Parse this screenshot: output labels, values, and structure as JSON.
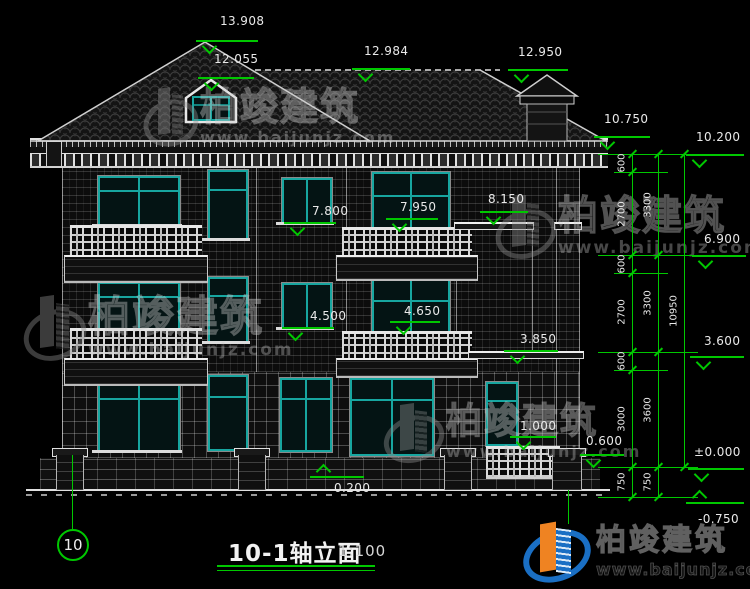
{
  "title_block": {
    "axis_no": "10",
    "title": "10-1轴立面",
    "scale": "1:100"
  },
  "brand": {
    "name": "柏竣建筑",
    "url": "www.baijunjz.com"
  },
  "colors": {
    "annotation_green": "#00c800",
    "window_teal": "#17a6a0",
    "line_white": "#d8d8d8",
    "logo_blue": "#1a6fc4",
    "logo_orange": "#ef8322"
  },
  "level_markers": [
    {
      "label": "13.908",
      "style": "down",
      "tx": 220,
      "ty": 14,
      "lx": 196,
      "ly": 40,
      "lw": 62
    },
    {
      "label": "12.055",
      "style": "down",
      "tx": 214,
      "ty": 52,
      "lx": 198,
      "ly": 77,
      "lw": 56
    },
    {
      "label": "12.984",
      "style": "down",
      "tx": 364,
      "ty": 44,
      "lx": 352,
      "ly": 68,
      "lw": 58
    },
    {
      "label": "12.950",
      "style": "down",
      "tx": 518,
      "ty": 45,
      "lx": 508,
      "ly": 69,
      "lw": 60
    },
    {
      "label": "10.750",
      "style": "down",
      "tx": 604,
      "ty": 112,
      "lx": 594,
      "ly": 136,
      "lw": 56
    },
    {
      "label": "10.200",
      "style": "down",
      "tx": 696,
      "ty": 130,
      "lx": 686,
      "ly": 154,
      "lw": 58
    },
    {
      "label": "6.900",
      "style": "down",
      "tx": 704,
      "ty": 232,
      "lx": 692,
      "ly": 255,
      "lw": 54
    },
    {
      "label": "3.600",
      "style": "down",
      "tx": 704,
      "ty": 334,
      "lx": 690,
      "ly": 356,
      "lw": 54
    },
    {
      "label": "±0.000",
      "style": "down",
      "tx": 694,
      "ty": 445,
      "lx": 688,
      "ly": 468,
      "lw": 56
    },
    {
      "label": "7.800",
      "style": "down",
      "tx": 312,
      "ty": 204,
      "lx": 284,
      "ly": 222,
      "lw": 52
    },
    {
      "label": "7.950",
      "style": "down",
      "tx": 400,
      "ty": 200,
      "lx": 386,
      "ly": 218,
      "lw": 52
    },
    {
      "label": "8.150",
      "style": "down",
      "tx": 488,
      "ty": 192,
      "lx": 480,
      "ly": 211,
      "lw": 48
    },
    {
      "label": "4.500",
      "style": "down",
      "tx": 310,
      "ty": 309,
      "lx": 282,
      "ly": 327,
      "lw": 52
    },
    {
      "label": "4.650",
      "style": "down",
      "tx": 404,
      "ty": 304,
      "lx": 390,
      "ly": 321,
      "lw": 50
    },
    {
      "label": "3.850",
      "style": "down",
      "tx": 520,
      "ty": 332,
      "lx": 504,
      "ly": 350,
      "lw": 54
    },
    {
      "label": "1.000",
      "style": "down",
      "tx": 520,
      "ty": 419,
      "lx": 510,
      "ly": 436,
      "lw": 46
    },
    {
      "label": "0.600",
      "style": "down",
      "tx": 586,
      "ty": 434,
      "lx": 580,
      "ly": 454,
      "lw": 44
    },
    {
      "label": "0.200",
      "style": "up",
      "tx": 334,
      "ty": 481,
      "lx": 310,
      "ly": 476,
      "lw": 54
    },
    {
      "label": "-0.750",
      "style": "up",
      "tx": 698,
      "ty": 512,
      "lx": 686,
      "ly": 502,
      "lw": 58
    }
  ],
  "dim_chains": {
    "extension_lines": [
      {
        "x": 598,
        "y": 154,
        "w": 100
      },
      {
        "x": 614,
        "y": 172,
        "w": 54
      },
      {
        "x": 598,
        "y": 255,
        "w": 100
      },
      {
        "x": 614,
        "y": 273,
        "w": 54
      },
      {
        "x": 598,
        "y": 352,
        "w": 100
      },
      {
        "x": 614,
        "y": 370,
        "w": 54
      },
      {
        "x": 598,
        "y": 467,
        "w": 100
      },
      {
        "x": 598,
        "y": 497,
        "w": 100
      }
    ],
    "chain_lines": [
      {
        "x": 632,
        "y1": 154,
        "y2": 497
      },
      {
        "x": 658,
        "y1": 154,
        "y2": 497
      },
      {
        "x": 684,
        "y1": 154,
        "y2": 467
      }
    ],
    "ticks": [
      {
        "x": 632,
        "y": 154
      },
      {
        "x": 632,
        "y": 172
      },
      {
        "x": 632,
        "y": 255
      },
      {
        "x": 632,
        "y": 273
      },
      {
        "x": 632,
        "y": 352
      },
      {
        "x": 632,
        "y": 370
      },
      {
        "x": 632,
        "y": 467
      },
      {
        "x": 632,
        "y": 497
      },
      {
        "x": 658,
        "y": 154
      },
      {
        "x": 658,
        "y": 255
      },
      {
        "x": 658,
        "y": 352
      },
      {
        "x": 658,
        "y": 467
      },
      {
        "x": 658,
        "y": 497
      },
      {
        "x": 684,
        "y": 154
      },
      {
        "x": 684,
        "y": 467
      }
    ],
    "labels": [
      {
        "text": "600",
        "x": 622,
        "y": 163
      },
      {
        "text": "2700",
        "x": 622,
        "y": 214
      },
      {
        "text": "600",
        "x": 622,
        "y": 264
      },
      {
        "text": "2700",
        "x": 622,
        "y": 312
      },
      {
        "text": "600",
        "x": 622,
        "y": 361
      },
      {
        "text": "3000",
        "x": 622,
        "y": 419
      },
      {
        "text": "750",
        "x": 622,
        "y": 482
      },
      {
        "text": "3300",
        "x": 648,
        "y": 205
      },
      {
        "text": "3300",
        "x": 648,
        "y": 303
      },
      {
        "text": "3600",
        "x": 648,
        "y": 410
      },
      {
        "text": "750",
        "x": 648,
        "y": 482
      },
      {
        "text": "10950",
        "x": 674,
        "y": 311
      }
    ]
  },
  "watermarks": [
    {
      "x": 146,
      "y": 88,
      "iw": 46,
      "ih": 58,
      "ts": 38,
      "us": 16
    },
    {
      "x": 498,
      "y": 196,
      "iw": 52,
      "ih": 62,
      "ts": 40,
      "us": 17
    },
    {
      "x": 26,
      "y": 296,
      "iw": 54,
      "ih": 64,
      "ts": 42,
      "us": 17
    },
    {
      "x": 386,
      "y": 404,
      "iw": 52,
      "ih": 58,
      "ts": 36,
      "us": 16
    }
  ]
}
